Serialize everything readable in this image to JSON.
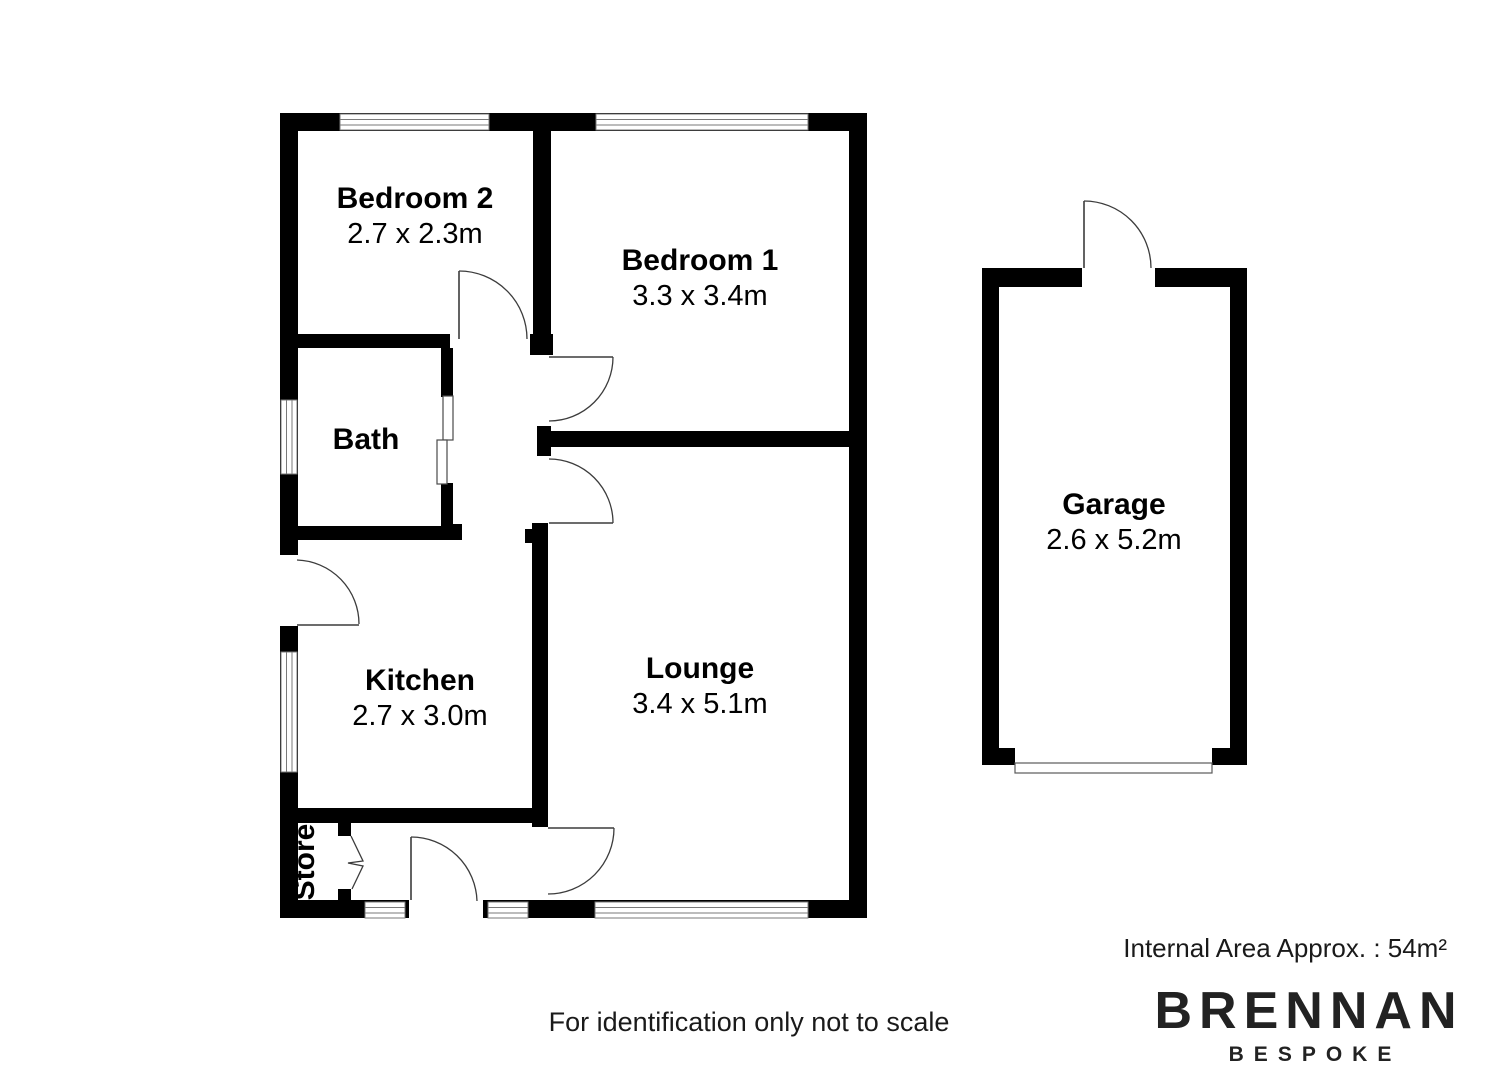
{
  "plan": {
    "rooms": [
      {
        "id": "bedroom2",
        "name": "Bedroom 2",
        "dims": "2.7 x 2.3m"
      },
      {
        "id": "bedroom1",
        "name": "Bedroom 1",
        "dims": "3.3 x 3.4m"
      },
      {
        "id": "bath",
        "name": "Bath",
        "dims": ""
      },
      {
        "id": "kitchen",
        "name": "Kitchen",
        "dims": "2.7 x 3.0m"
      },
      {
        "id": "lounge",
        "name": "Lounge",
        "dims": "3.4 x 5.1m"
      },
      {
        "id": "store",
        "name": "Store",
        "dims": ""
      },
      {
        "id": "garage",
        "name": "Garage",
        "dims": "2.6 x 5.2m"
      }
    ]
  },
  "footer": {
    "disclaimer": "For identification only not to scale",
    "internal_area": "Internal Area Approx. : 54m²"
  },
  "branding": {
    "name": "BRENNAN",
    "tagline": "BESPOKE"
  },
  "colors": {
    "wall": "#000000",
    "background": "#ffffff",
    "door_arc": "#3c3c3c"
  }
}
